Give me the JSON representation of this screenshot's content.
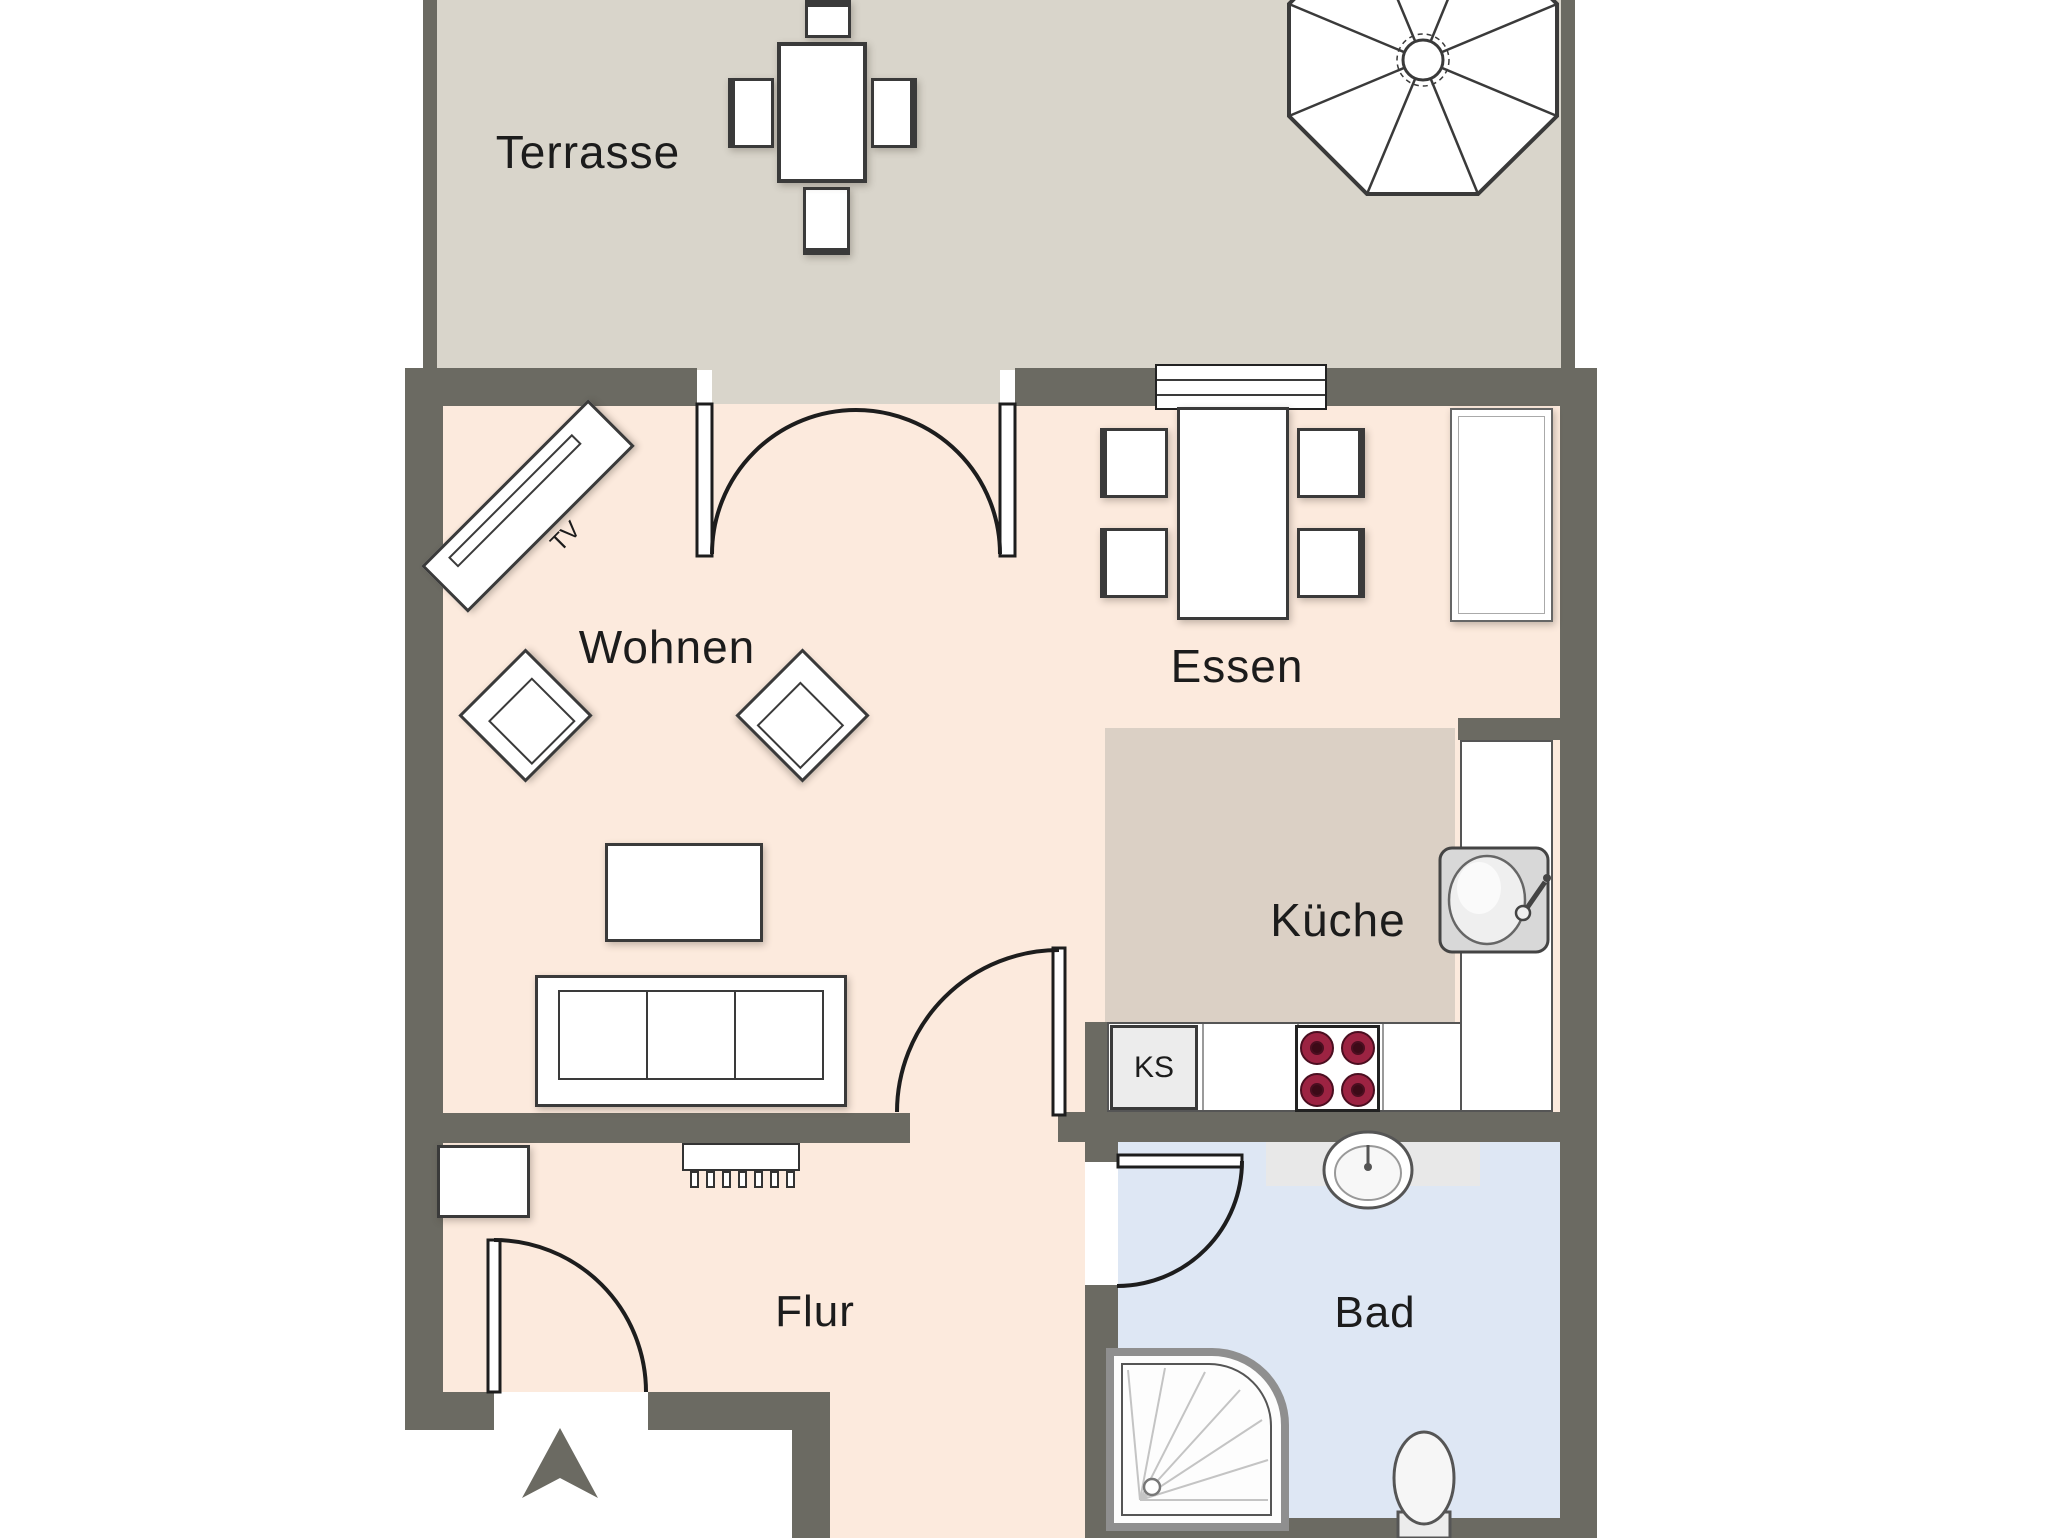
{
  "plan": {
    "type": "apartment-floor-plan",
    "language": "de"
  },
  "rooms": {
    "terrasse": {
      "label": "Terrasse"
    },
    "wohnen": {
      "label": "Wohnen"
    },
    "essen": {
      "label": "Essen"
    },
    "kueche": {
      "label": "Küche"
    },
    "flur": {
      "label": "Flur"
    },
    "bad": {
      "label": "Bad"
    }
  },
  "furniture": {
    "tv_label": "TV",
    "ks_label": "KS",
    "items": [
      "patio-umbrella",
      "terrace-table",
      "terrace-chairs",
      "french-double-door",
      "tv-sideboard",
      "armchairs",
      "coffee-table",
      "sofa",
      "dining-table",
      "dining-chairs",
      "window",
      "tall-cabinet",
      "kitchen-counter",
      "kitchen-sink",
      "fridge-KS",
      "stove-4-burners",
      "radiator",
      "wardrobe",
      "entrance-door",
      "entrance-arrow",
      "bath-door",
      "bath-basin",
      "corner-shower",
      "toilet"
    ]
  },
  "colors": {
    "wall": "#6b6a62",
    "terrace_floor": "#d9d5cb",
    "room_floor": "#fceadd",
    "kitchen_floor": "#dbd0c5",
    "bath_floor": "#dee7f4",
    "burner": "#9c2342",
    "background": "#ffffff"
  }
}
